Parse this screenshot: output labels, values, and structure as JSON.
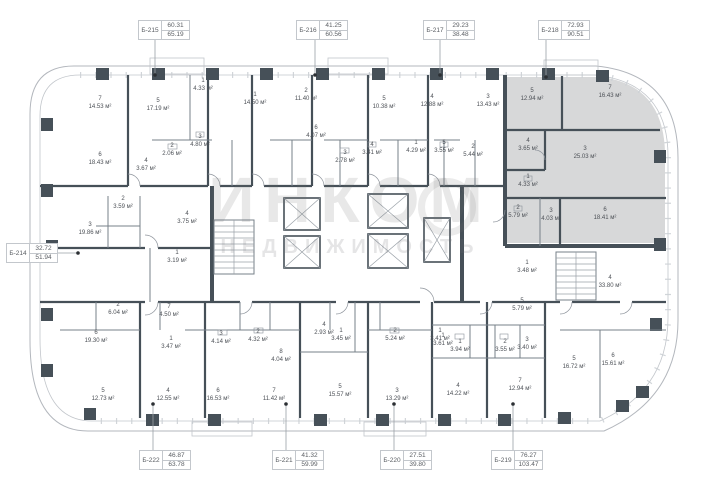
{
  "watermark": {
    "title": "ИНКОМ",
    "subtitle": "НЕДВИЖИМОСТЬ"
  },
  "area_unit": "м²",
  "unit_tags": [
    {
      "id": "Б-215",
      "top": "60.31",
      "bottom": "65.19",
      "x": 138,
      "y": 20
    },
    {
      "id": "Б-216",
      "top": "41.25",
      "bottom": "60.56",
      "x": 296,
      "y": 20
    },
    {
      "id": "Б-217",
      "top": "29.23",
      "bottom": "38.48",
      "x": 423,
      "y": 20
    },
    {
      "id": "Б-218",
      "top": "72.93",
      "bottom": "90.51",
      "x": 538,
      "y": 20
    },
    {
      "id": "Б-214",
      "top": "32.72",
      "bottom": "51.94",
      "x": 6,
      "y": 243
    },
    {
      "id": "Б-222",
      "top": "46.87",
      "bottom": "63.78",
      "x": 139,
      "y": 450
    },
    {
      "id": "Б-221",
      "top": "41.32",
      "bottom": "59.99",
      "x": 272,
      "y": 450
    },
    {
      "id": "Б-220",
      "top": "27.51",
      "bottom": "39.80",
      "x": 380,
      "y": 450
    },
    {
      "id": "Б-219",
      "top": "76.27",
      "bottom": "103.47",
      "x": 491,
      "y": 450
    }
  ],
  "rooms": [
    {
      "n": "7",
      "area": "14.53",
      "x": 100,
      "y": 104
    },
    {
      "n": "5",
      "area": "17.19",
      "x": 158,
      "y": 106
    },
    {
      "n": "1",
      "area": "4.33",
      "x": 203,
      "y": 86
    },
    {
      "n": "6",
      "area": "18.43",
      "x": 100,
      "y": 160
    },
    {
      "n": "4",
      "area": "3.67",
      "x": 146,
      "y": 166
    },
    {
      "n": "2",
      "area": "2.06",
      "x": 172,
      "y": 151
    },
    {
      "n": "3",
      "area": "4.80",
      "x": 200,
      "y": 142
    },
    {
      "n": "1",
      "area": "14.50",
      "x": 255,
      "y": 100
    },
    {
      "n": "2",
      "area": "11.40",
      "x": 306,
      "y": 96
    },
    {
      "n": "6",
      "area": "4.07",
      "x": 316,
      "y": 133
    },
    {
      "n": "3",
      "area": "2.78",
      "x": 345,
      "y": 158
    },
    {
      "n": "5",
      "area": "10.38",
      "x": 384,
      "y": 104
    },
    {
      "n": "4",
      "area": "3.41",
      "x": 372,
      "y": 150
    },
    {
      "n": "4",
      "area": "12.88",
      "x": 432,
      "y": 102
    },
    {
      "n": "1",
      "area": "4.29",
      "x": 416,
      "y": 148
    },
    {
      "n": "5",
      "area": "3.55",
      "x": 444,
      "y": 148
    },
    {
      "n": "3",
      "area": "13.43",
      "x": 488,
      "y": 102
    },
    {
      "n": "2",
      "area": "5.44",
      "x": 473,
      "y": 152
    },
    {
      "n": "5",
      "area": "12.94",
      "x": 532,
      "y": 96,
      "hl": true
    },
    {
      "n": "7",
      "area": "16.43",
      "x": 610,
      "y": 93,
      "hl": true
    },
    {
      "n": "4",
      "area": "3.65",
      "x": 528,
      "y": 146,
      "hl": true
    },
    {
      "n": "3",
      "area": "25.03",
      "x": 585,
      "y": 154,
      "hl": true
    },
    {
      "n": "1",
      "area": "4.33",
      "x": 528,
      "y": 182,
      "hl": true
    },
    {
      "n": "2",
      "area": "5.79",
      "x": 518,
      "y": 213,
      "hl": true
    },
    {
      "n": "3",
      "area": "4.03",
      "x": 551,
      "y": 216,
      "hl": true
    },
    {
      "n": "6",
      "area": "18.41",
      "x": 605,
      "y": 215,
      "hl": true
    },
    {
      "n": "2",
      "area": "3.59",
      "x": 123,
      "y": 204
    },
    {
      "n": "4",
      "area": "3.75",
      "x": 187,
      "y": 219
    },
    {
      "n": "3",
      "area": "19.86",
      "x": 90,
      "y": 230
    },
    {
      "n": "1",
      "area": "3.19",
      "x": 177,
      "y": 258
    },
    {
      "n": "1",
      "area": "3.48",
      "x": 527,
      "y": 268
    },
    {
      "n": "4",
      "area": "33.80",
      "x": 610,
      "y": 283
    },
    {
      "n": "2",
      "area": "6.04",
      "x": 118,
      "y": 310
    },
    {
      "n": "7",
      "area": "4.50",
      "x": 169,
      "y": 312
    },
    {
      "n": "6",
      "area": "19.30",
      "x": 96,
      "y": 338
    },
    {
      "n": "1",
      "area": "3.47",
      "x": 171,
      "y": 344
    },
    {
      "n": "5",
      "area": "12.73",
      "x": 103,
      "y": 396
    },
    {
      "n": "4",
      "area": "12.55",
      "x": 168,
      "y": 396
    },
    {
      "n": "3",
      "area": "4.14",
      "x": 221,
      "y": 339
    },
    {
      "n": "2",
      "area": "4.32",
      "x": 258,
      "y": 337
    },
    {
      "n": "8",
      "area": "4.04",
      "x": 281,
      "y": 357
    },
    {
      "n": "6",
      "area": "16.53",
      "x": 218,
      "y": 396
    },
    {
      "n": "7",
      "area": "11.42",
      "x": 274,
      "y": 396
    },
    {
      "n": "4",
      "area": "2.93",
      "x": 324,
      "y": 330
    },
    {
      "n": "1",
      "area": "3.45",
      "x": 341,
      "y": 336
    },
    {
      "n": "5",
      "area": "15.57",
      "x": 340,
      "y": 392
    },
    {
      "n": "2",
      "area": "5.24",
      "x": 395,
      "y": 336
    },
    {
      "n": "3",
      "area": "13.29",
      "x": 397,
      "y": 396
    },
    {
      "n": "1",
      "area": "3.41",
      "x": 440,
      "y": 336
    },
    {
      "n": "5",
      "area": "5.79",
      "x": 522,
      "y": 306
    },
    {
      "n": "1",
      "area": "3.61",
      "x": 443,
      "y": 341
    },
    {
      "n": "1",
      "area": "3.94",
      "x": 460,
      "y": 347
    },
    {
      "n": "2",
      "area": "3.55",
      "x": 505,
      "y": 347
    },
    {
      "n": "3",
      "area": "3.40",
      "x": 527,
      "y": 345
    },
    {
      "n": "4",
      "area": "14.22",
      "x": 458,
      "y": 391
    },
    {
      "n": "7",
      "area": "12.94",
      "x": 520,
      "y": 386
    },
    {
      "n": "5",
      "area": "16.72",
      "x": 574,
      "y": 364
    },
    {
      "n": "6",
      "area": "15.61",
      "x": 613,
      "y": 361
    }
  ]
}
